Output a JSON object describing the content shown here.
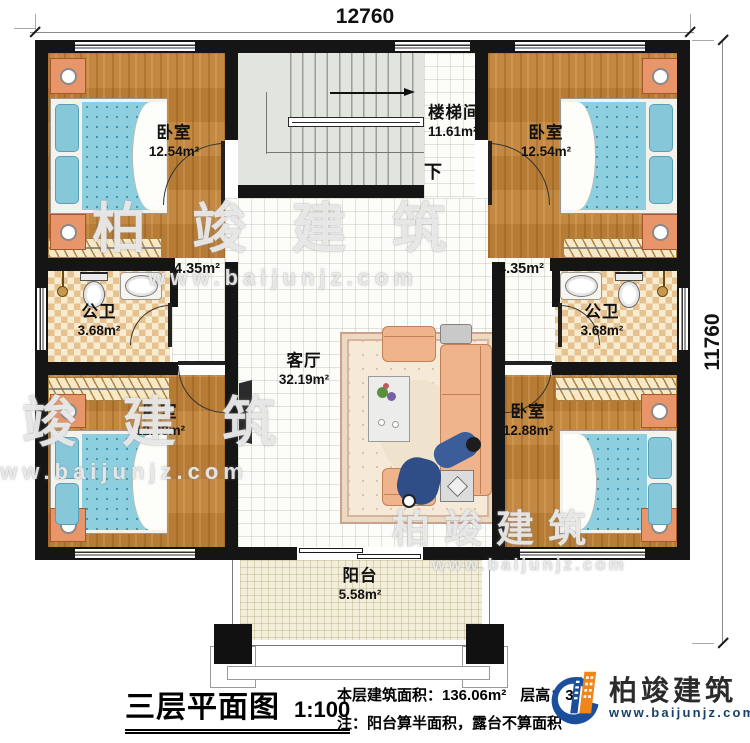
{
  "dimensions": {
    "top": "12760",
    "right": "11760"
  },
  "rooms": {
    "bedroom_tl": {
      "name": "卧室",
      "area": "12.54m²"
    },
    "bedroom_tr": {
      "name": "卧室",
      "area": "12.54m²"
    },
    "stairwell": {
      "name": "楼梯间",
      "area": "11.61m²",
      "down": "下"
    },
    "hall_left": {
      "area": "4.35m²"
    },
    "hall_right": {
      "area": "4.35m²"
    },
    "bath_left": {
      "name": "公卫",
      "area": "3.68m²"
    },
    "bath_right": {
      "name": "公卫",
      "area": "3.68m²"
    },
    "living": {
      "name": "客厅",
      "area": "32.19m²"
    },
    "bedroom_bl": {
      "name": "卧室",
      "area": "12.88m²"
    },
    "bedroom_br": {
      "name": "卧室",
      "area": "12.88m²"
    },
    "balcony": {
      "name": "阳台",
      "area": "5.58m²"
    }
  },
  "watermark": {
    "line1": "柏竣建筑",
    "line2": "www.baijunjz.com"
  },
  "footer": {
    "title": "三层平面图",
    "scale": "1:100",
    "area_label": "本层建筑面积：136.06m²",
    "height_label": "层高：3",
    "note": "注：阳台算半面积，露台不算面积"
  },
  "logo": {
    "name": "柏竣建筑",
    "url": "www.baijunjz.com"
  },
  "colors": {
    "wall": "#151515",
    "wood": "#c08238",
    "accent_blue": "#1b4f9c",
    "accent_orange": "#f08519"
  }
}
